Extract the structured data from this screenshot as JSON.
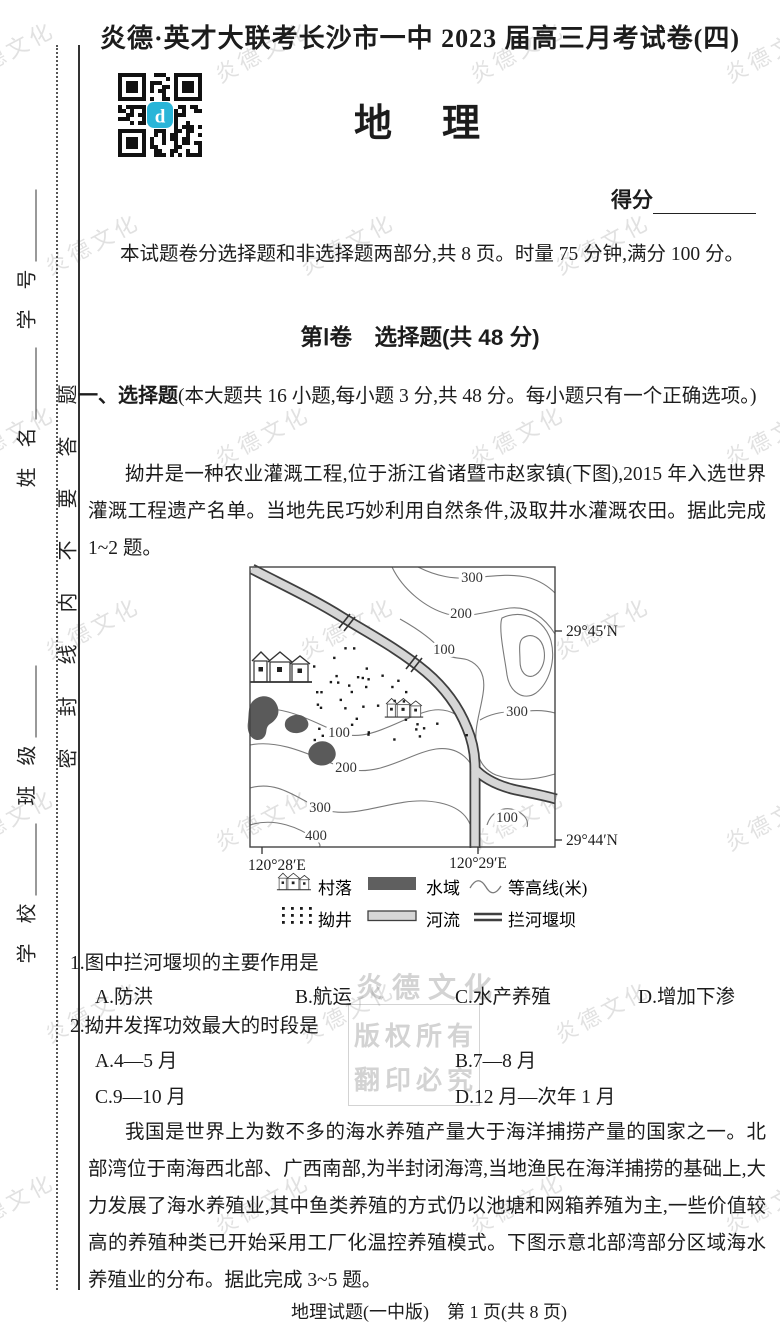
{
  "page": {
    "header_title": "炎德·英才大联考长沙市一中 2023 届高三月考试卷(四)",
    "subject_title": "地　理",
    "score_label": "得分",
    "footer": "地理试题(一中版)　第 1 页(共 8 页)"
  },
  "sidebar": {
    "seal_text": "密封线内不要答题",
    "fields": [
      "学　校",
      "班　级",
      "姓　名",
      "学　号"
    ]
  },
  "watermark": {
    "tile_text": "炎德文化",
    "center_lines": [
      "炎德文化",
      "版权所有",
      "翻印必究"
    ]
  },
  "intro": "本试题卷分选择题和非选择题两部分,共 8 页。时量 75 分钟,满分 100 分。",
  "section1": {
    "heading": "第Ⅰ卷　选择题(共 48 分)",
    "directions_label": "一、选择题",
    "directions_rest": "(本大题共 16 小题,每小题 3 分,共 48 分。每小题只有一个正确选项。)"
  },
  "passage1": "拗井是一种农业灌溉工程,位于浙江省诸暨市赵家镇(下图),2015 年入选世界灌溉工程遗产名单。当地先民巧妙利用自然条件,汲取井水灌溉农田。据此完成 1~2 题。",
  "map": {
    "contour_labels": [
      "300",
      "200",
      "100",
      "300",
      "100",
      "200",
      "300",
      "400",
      "100"
    ],
    "lon_labels": [
      "120°28′E",
      "120°29′E"
    ],
    "lat_labels": [
      "29°45′N",
      "29°44′N"
    ],
    "legend": {
      "village": "村落",
      "water": "水域",
      "contour": "等高线(米)",
      "well": "拗井",
      "river": "河流",
      "weir": "拦河堰坝"
    }
  },
  "questions": [
    {
      "stem": "1.图中拦河堰坝的主要作用是",
      "options": [
        "A.防洪",
        "B.航运",
        "C.水产养殖",
        "D.增加下渗"
      ]
    },
    {
      "stem": "2.拗井发挥功效最大的时段是",
      "options": [
        "A.4—5 月",
        "B.7—8 月",
        "C.9—10 月",
        "D.12 月—次年 1 月"
      ]
    }
  ],
  "passage2": "我国是世界上为数不多的海水养殖产量大于海洋捕捞产量的国家之一。北部湾位于南海西北部、广西南部,为半封闭海湾,当地渔民在海洋捕捞的基础上,大力发展了海水养殖业,其中鱼类养殖的方式仍以池塘和网箱养殖为主,一些价值较高的养殖种类已开始采用工厂化温控养殖模式。下图示意北部湾部分区域海水养殖业的分布。据此完成 3~5 题。",
  "qr_accent": "#29b5d8"
}
